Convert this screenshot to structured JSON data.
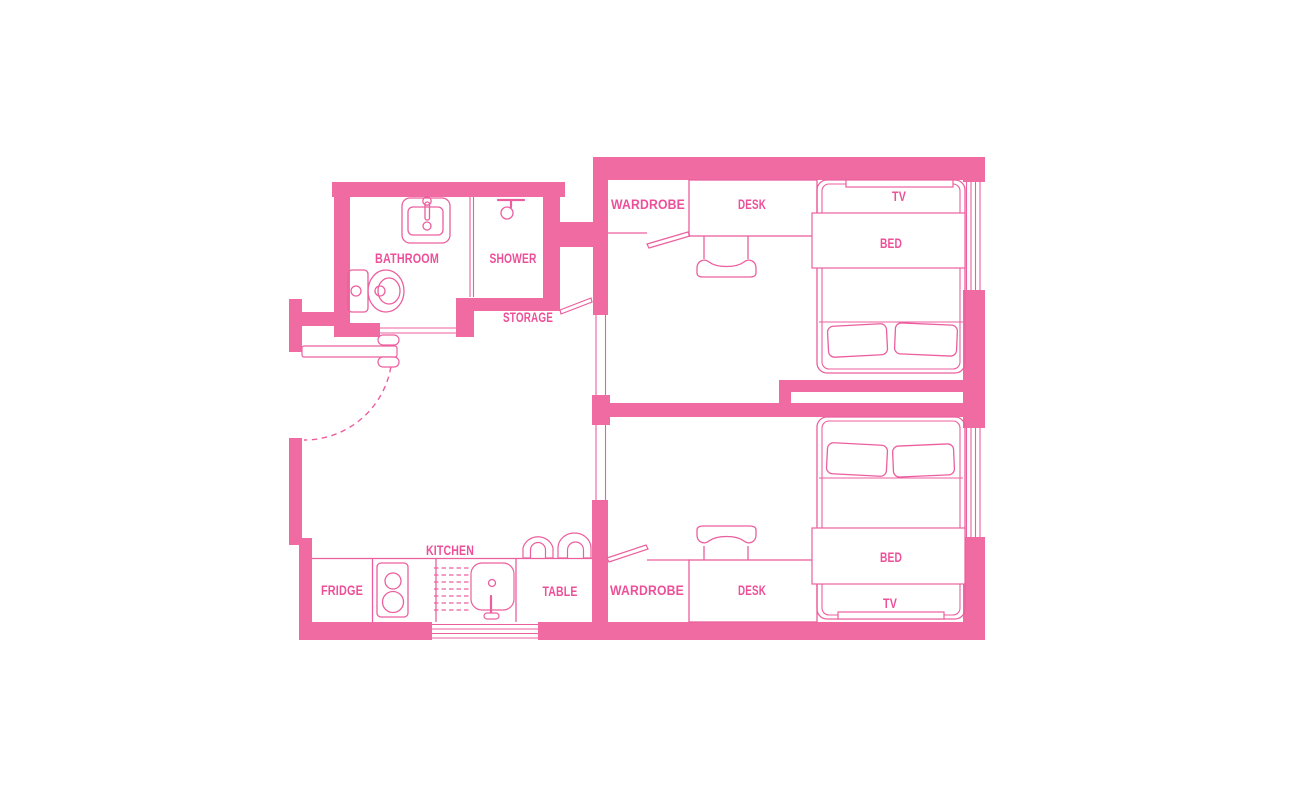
{
  "title": "Apartment floor plan",
  "colors": {
    "wall": "#ef6ba2",
    "line": "#ec5f9e",
    "text": "#ed4f98",
    "background": "#ffffff"
  },
  "labels": {
    "bathroom": "BATHROOM",
    "shower": "SHOWER",
    "storage": "STORAGE",
    "kitchen": "KITCHEN",
    "fridge": "FRIDGE",
    "table": "TABLE",
    "bedroom1": {
      "wardrobe": "WARDROBE",
      "desk": "DESK",
      "tv": "TV",
      "bed": "BED"
    },
    "bedroom2": {
      "wardrobe": "WARDROBE",
      "desk": "DESK",
      "tv": "TV",
      "bed": "BED"
    }
  }
}
